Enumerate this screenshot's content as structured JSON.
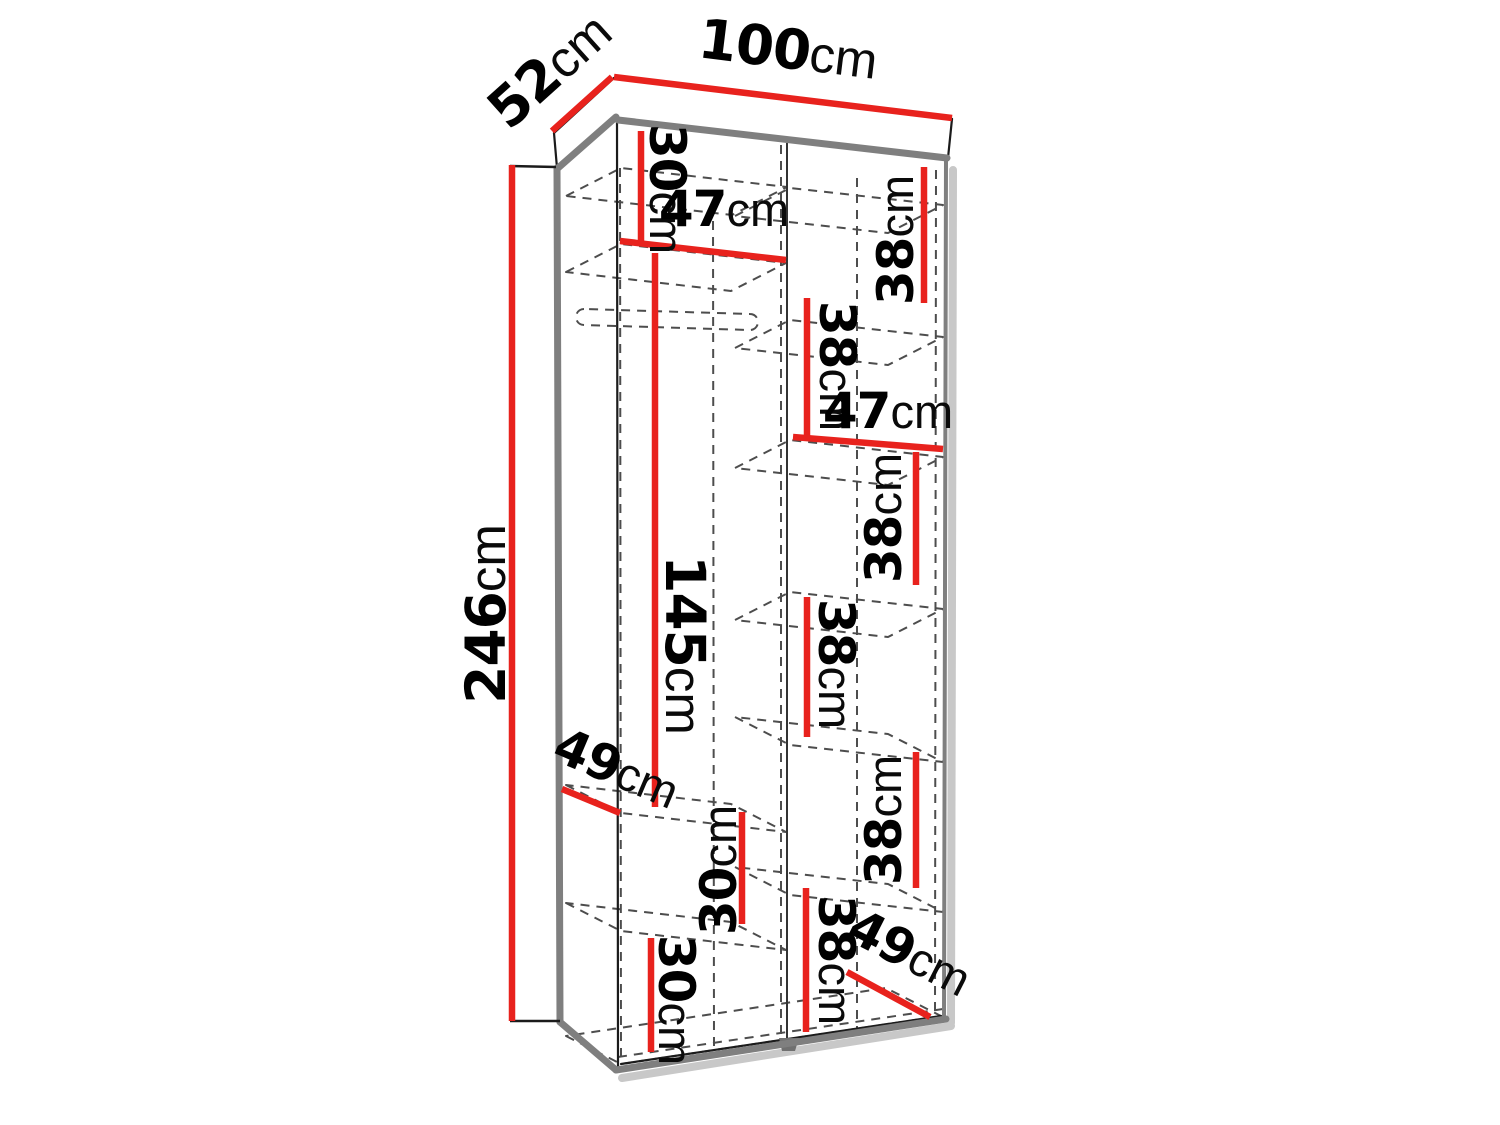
{
  "diagram": {
    "type": "furniture-dimension-drawing",
    "subject": "tall two-column wardrobe cabinet, open-front wireframe view",
    "unit": "cm",
    "overall": {
      "width_cm": 100,
      "depth_cm": 52,
      "height_cm": 246
    },
    "measurements": [
      {
        "id": "depth-top",
        "value": "52",
        "unit": "cm"
      },
      {
        "id": "width-top",
        "value": "100",
        "unit": "cm"
      },
      {
        "id": "height-left",
        "value": "246",
        "unit": "cm"
      },
      {
        "id": "left-top-shelf-gap",
        "value": "30",
        "unit": "cm"
      },
      {
        "id": "left-shelf-width",
        "value": "47",
        "unit": "cm"
      },
      {
        "id": "left-hanging-height",
        "value": "145",
        "unit": "cm"
      },
      {
        "id": "left-shelf-depth",
        "value": "49",
        "unit": "cm"
      },
      {
        "id": "left-lower-gap-1",
        "value": "30",
        "unit": "cm"
      },
      {
        "id": "left-lower-gap-2",
        "value": "30",
        "unit": "cm"
      },
      {
        "id": "right-gap-1",
        "value": "38",
        "unit": "cm"
      },
      {
        "id": "right-gap-2",
        "value": "38",
        "unit": "cm"
      },
      {
        "id": "right-shelf-width",
        "value": "47",
        "unit": "cm"
      },
      {
        "id": "right-gap-3",
        "value": "38",
        "unit": "cm"
      },
      {
        "id": "right-gap-4",
        "value": "38",
        "unit": "cm"
      },
      {
        "id": "right-gap-5",
        "value": "38",
        "unit": "cm"
      },
      {
        "id": "right-gap-6",
        "value": "38",
        "unit": "cm"
      },
      {
        "id": "right-shelf-depth",
        "value": "49",
        "unit": "cm"
      }
    ]
  },
  "colors": {
    "dimension": "#e8221d",
    "outline": "#1b1b1b",
    "edge": "#7f7f7f",
    "dashed": "#4d4d4d",
    "shadow": "#c8c8c8",
    "foot": "#707070",
    "background": "#ffffff"
  }
}
